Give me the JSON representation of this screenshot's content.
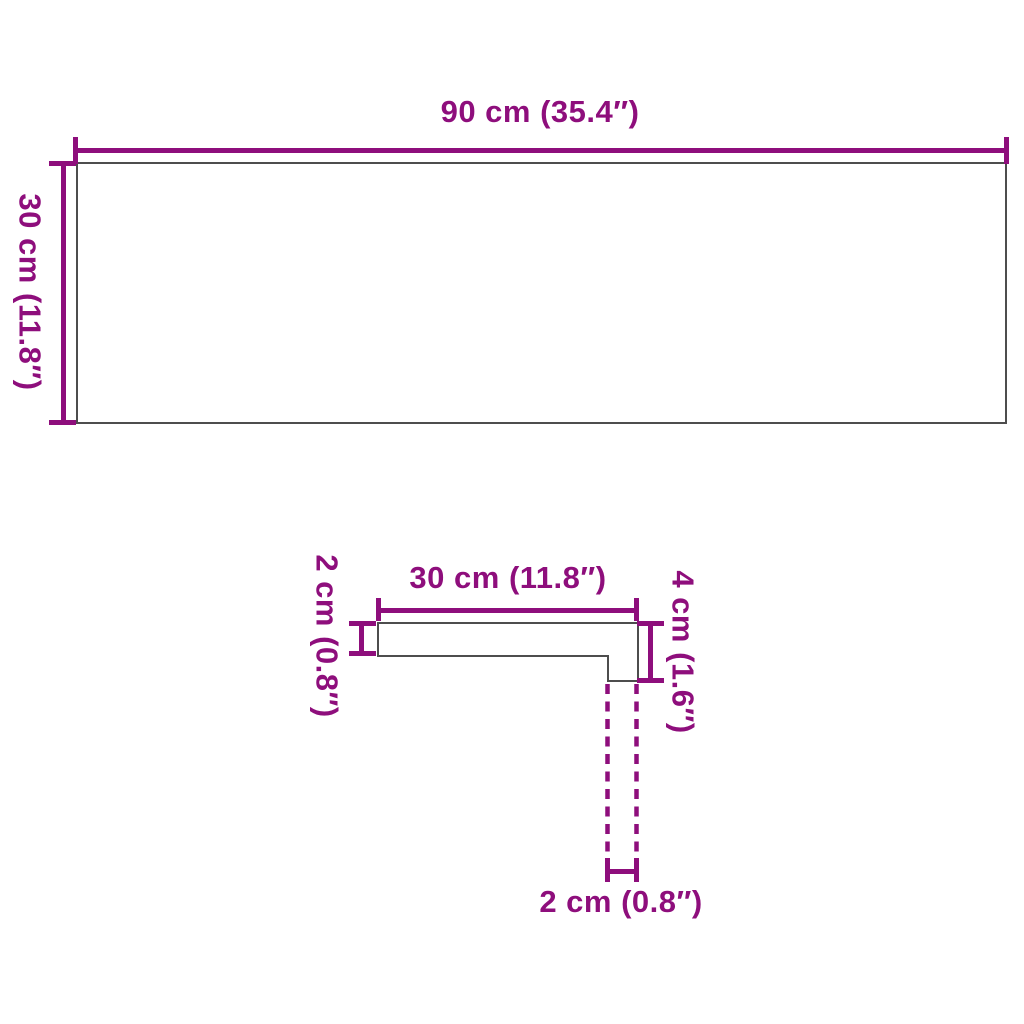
{
  "diagram_title": "stair tread dimension diagram",
  "colors": {
    "accent": "#8E0E7C",
    "outline": "#4d4d4d",
    "background": "#ffffff"
  },
  "top_view": {
    "width_label": "90 cm (35.4″)",
    "height_label": "30 cm (11.8″)"
  },
  "profile_view": {
    "depth_label": "30 cm (11.8″)",
    "thickness_label": "2 cm (0.8″)",
    "nose_height_label": "4 cm (1.6″)",
    "nose_width_label": "2 cm (0.8″)"
  }
}
